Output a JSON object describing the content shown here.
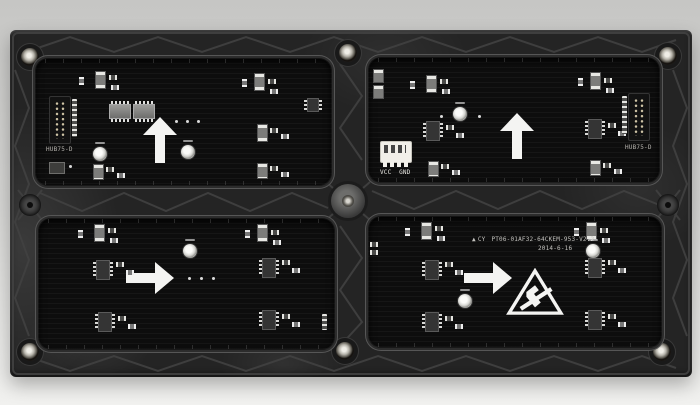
{
  "labels": {
    "hub75_port": "HUB75-D",
    "vcc": "VCC",
    "gnd": "GND",
    "brand": "CY",
    "model": "PT06-01AF32-64CKEM-953-V2.2",
    "date": "2014-6-16"
  },
  "glyphs": {
    "brand_triangle": "▲"
  },
  "icons": {
    "arrow_up": "white-orientation-arrow-up",
    "arrow_right": "white-orientation-arrow-right",
    "esd_triangle": "esd-sensitive-warning-triangle"
  },
  "colors": {
    "background_top": "#c6c6c4",
    "background_bottom": "#f1f1ef",
    "frame_plastic": "#242424",
    "frame_rib": "#424242",
    "pcb_black": "#0d0d0d",
    "silkscreen_white": "#e9e8e3",
    "arrow_white": "#f4f4f2",
    "screw_metal": "#b6b3aa",
    "power_connector": "#f1efe9",
    "idc_pin_gold": "#cfc4a6"
  }
}
